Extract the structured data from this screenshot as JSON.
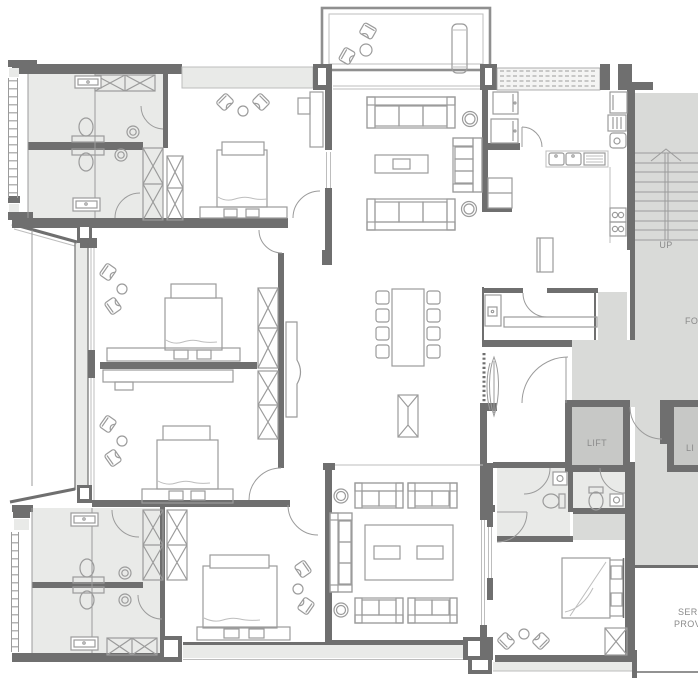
{
  "plan": {
    "type": "architectural-floor-plan",
    "labels": {
      "stairs_up": "UP",
      "foyer_partial": "FO",
      "lift_main": "LIFT",
      "lift_secondary_partial": "LI",
      "service_partial_line1": "SER",
      "service_partial_line2": "PROV"
    },
    "colors": {
      "wall": "#6f6f6f",
      "room-light": "#e9eae8",
      "area-mid": "#d9dad8",
      "lift-fill": "#c7c8c6",
      "furniture": "#9b9b9b",
      "line-light": "#bdbdbd",
      "label-text": "#8a8a8a",
      "background": "#ffffff"
    }
  }
}
